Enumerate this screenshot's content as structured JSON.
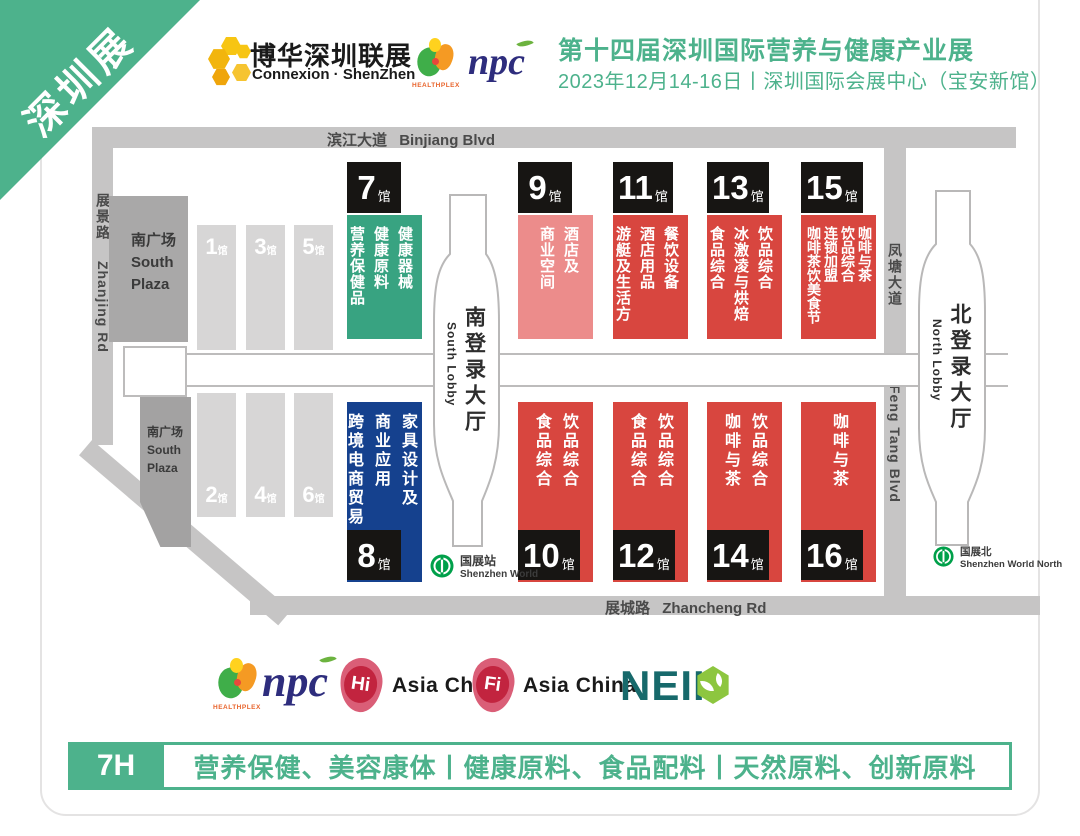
{
  "ribbon": {
    "label": "深圳展"
  },
  "header": {
    "brand_cn": "博华深圳联展",
    "brand_en": "Connexion · ShenZhen",
    "healthplex_label": "HEALTHPLEX",
    "npc_label": "npc",
    "title": "第十四届深圳国际营养与健康产业展",
    "subtitle": "2023年12月14-16日丨深圳国际会展中心（宝安新馆）"
  },
  "map": {
    "roads": {
      "top_cn": "滨江大道",
      "top_en": "Binjiang Blvd",
      "left_cn": "展景路",
      "left_en": "Zhanjing Rd",
      "right_cn": "凤塘大道",
      "right_en": "Feng Tang Blvd",
      "bottom_cn": "展城路",
      "bottom_en": "Zhancheng Rd"
    },
    "south_plaza_lines": [
      "南广场",
      "South",
      "Plaza"
    ],
    "lobby_south_cn": "南登录大厅",
    "lobby_south_en": "South Lobby",
    "lobby_north_cn": "北登录大厅",
    "lobby_north_en": "North Lobby",
    "metro_south_cn": "国展站",
    "metro_south_en": "Shenzhen World",
    "metro_north_cn": "国展北",
    "metro_north_en": "Shenzhen World North",
    "hall_suffix": "馆",
    "gray_halls_top": [
      "1",
      "3",
      "5"
    ],
    "gray_halls_bottom": [
      "2",
      "4",
      "6"
    ],
    "halls": {
      "h7": {
        "num": "7",
        "cols": [
          "健康器械",
          "健康原料",
          "营养保健品"
        ]
      },
      "h9": {
        "num": "9",
        "cols": [
          "酒店及",
          "商业空间"
        ]
      },
      "h11": {
        "num": "11",
        "cols": [
          "餐饮设备",
          "酒店用品",
          "游艇及生活方式"
        ]
      },
      "h13": {
        "num": "13",
        "cols": [
          "饮品综合",
          "冰激凌与烘焙",
          "食品综合"
        ]
      },
      "h15": {
        "num": "15",
        "cols": [
          "咖啡与茶",
          "饮品综合",
          "连锁加盟",
          "咖啡茶饮美食节"
        ]
      },
      "h8": {
        "num": "8",
        "cols": [
          "家具设计及",
          "商业应用",
          "跨境电商贸易"
        ]
      },
      "h10": {
        "num": "10",
        "cols": [
          "饮品综合",
          "食品综合"
        ]
      },
      "h12": {
        "num": "12",
        "cols": [
          "饮品综合",
          "食品综合"
        ]
      },
      "h14": {
        "num": "14",
        "cols": [
          "饮品综合",
          "咖啡与茶"
        ]
      },
      "h16": {
        "num": "16",
        "cols": [
          "咖啡与茶"
        ]
      }
    }
  },
  "partners": {
    "healthplex_label": "HEALTHPLEX",
    "npc_label": "npc",
    "hi_badge": "Hi",
    "hi_label": "Asia China",
    "fi_badge": "Fi",
    "fi_label": "Asia China",
    "neii_label": "NEII"
  },
  "banner": {
    "hall": "7H",
    "text": "营养保健、美容康体丨健康原料、食品配料丨天然原料、创新原料"
  },
  "colors": {
    "accent_green": "#4DB28C",
    "hall_green": "#38A381",
    "hall_red": "#D8463F",
    "hall_pink": "#EC8C8B",
    "hall_blue": "#15418E",
    "tag_black": "#171513",
    "road_gray": "#C6C5C5",
    "metro_green": "#00A04A"
  }
}
